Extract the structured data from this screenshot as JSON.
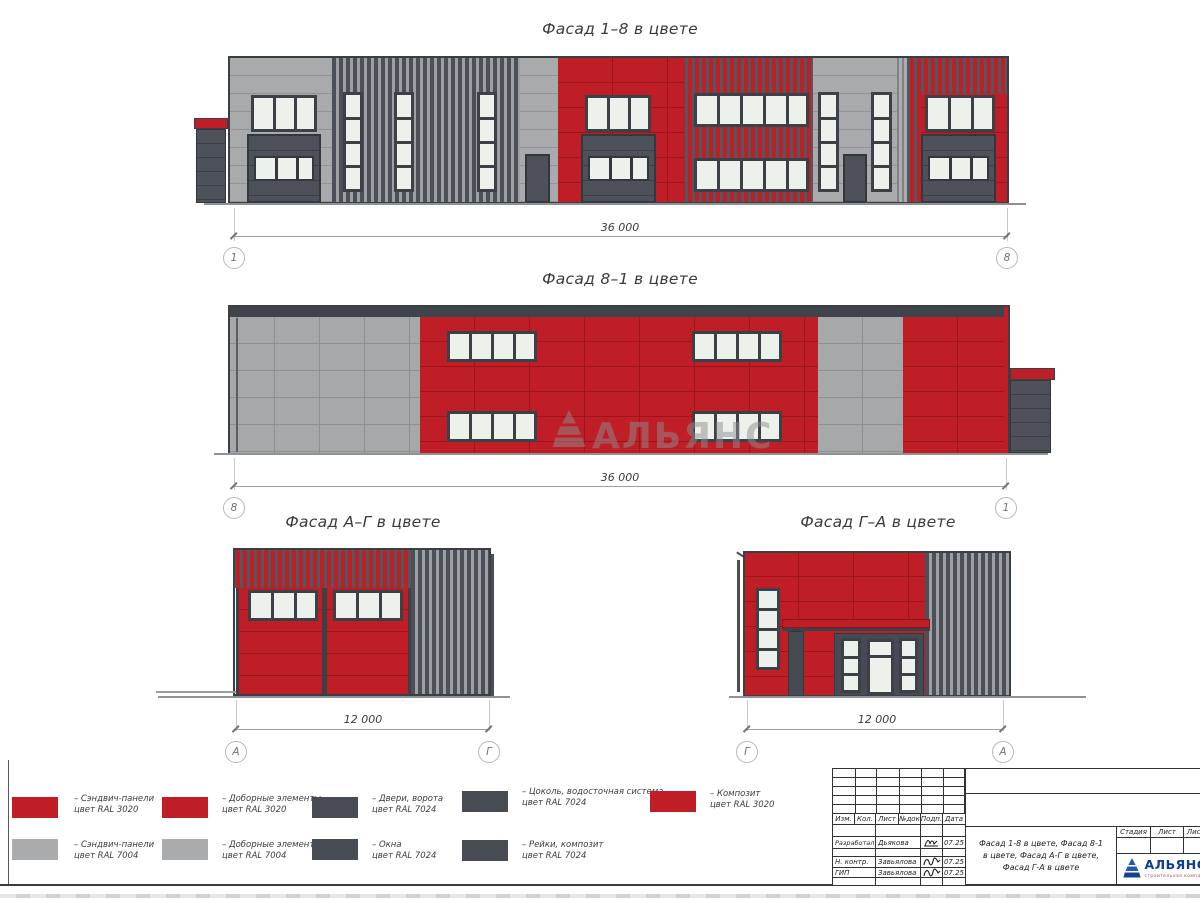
{
  "facades": {
    "f18": {
      "title": "Фасад 1–8 в цвете",
      "dim": "36 000",
      "axisL": "1",
      "axisR": "8"
    },
    "f81": {
      "title": "Фасад 8–1 в цвете",
      "dim": "36 000",
      "axisL": "8",
      "axisR": "1"
    },
    "fag": {
      "title": "Фасад А–Г в цвете",
      "dim": "12 000",
      "axisL": "А",
      "axisR": "Г"
    },
    "fga": {
      "title": "Фасад Г–А в цвете",
      "dim": "12 000",
      "axisL": "Г",
      "axisR": "А"
    }
  },
  "watermark": {
    "text": "АЛЬЯНС"
  },
  "legend": {
    "items": [
      {
        "color": "red",
        "line1": "– Сэндвич-панели",
        "line2": "цвет RAL 3020"
      },
      {
        "color": "red",
        "line1": "– Доборные элементы",
        "line2": "цвет RAL 3020"
      },
      {
        "color": "dark",
        "line1": "– Двери, ворота",
        "line2": "цвет RAL 7024"
      },
      {
        "color": "dark",
        "line1": "– Цоколь, водосточная система",
        "line2": "цвет RAL 7024"
      },
      {
        "color": "red",
        "line1": "– Композит",
        "line2": "цвет RAL 3020"
      },
      {
        "color": "gray",
        "line1": "– Сэндвич-панели",
        "line2": "цвет RAL 7004"
      },
      {
        "color": "gray",
        "line1": "– Доборные элементы",
        "line2": "цвет RAL 7004"
      },
      {
        "color": "dark",
        "line1": "– Окна",
        "line2": "цвет RAL 7024"
      },
      {
        "color": "dark",
        "line1": "– Рейки, композит",
        "line2": "цвет RAL 7024"
      }
    ]
  },
  "titleblock": {
    "header": {
      "izm": "Изм.",
      "kol": "Кол.",
      "list": "Лист",
      "ndok": "№док",
      "podp": "Подп.",
      "data": "Дата"
    },
    "rows": [
      {
        "role": "Разработал",
        "name": "Дьякова",
        "date": "07.25"
      },
      {
        "role": "Н. контр.",
        "name": "Завьялова",
        "date": "07.25"
      },
      {
        "role": "ГИП",
        "name": "Завьялова",
        "date": "07.25"
      }
    ],
    "stage": {
      "stadia": "Стадия",
      "list": "Лист",
      "listov": "Листов"
    },
    "doc_title_lines": [
      "Фасад 1-8 в цвете, Фасад 8-1",
      "в цвете, Фасад А-Г в цвете,",
      "Фасад Г-А в цвете"
    ],
    "logo": {
      "name": "АЛЬЯНС",
      "sub": "строительная компания"
    }
  },
  "colors": {
    "ral3020_red": "#bf1e27",
    "ral7004_gray": "#a9abad",
    "ral7024_dark": "#474c54",
    "window_glass": "#edf1ec",
    "logo_blue": "#0d3e8f"
  }
}
